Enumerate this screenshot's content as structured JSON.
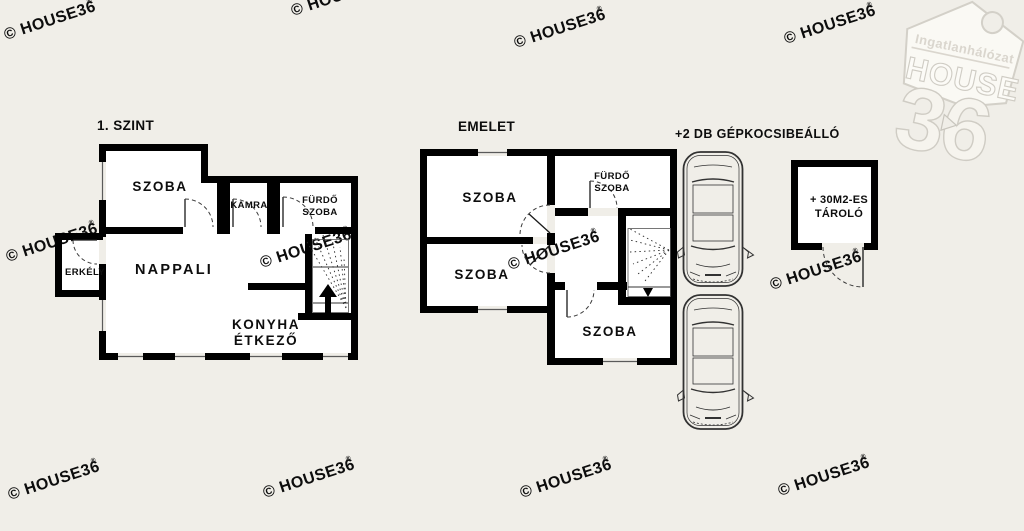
{
  "colors": {
    "background": "#f0eee8",
    "wall": "#000000",
    "room_fill": "#ffffff",
    "watermark": "#dad6ce",
    "logo_outline": "#cfccc4"
  },
  "watermark": {
    "text": "© HOUSE36",
    "reg": "®"
  },
  "logo": {
    "network": "Ingatlanhálózat",
    "brand": "HOUSE",
    "number": "36"
  },
  "floor1": {
    "title": "1. SZINT",
    "rooms": {
      "szoba": "SZOBA",
      "kamra": "KAMRA",
      "furdo_line1": "FÜRDŐ",
      "furdo_line2": "SZOBA",
      "nappali": "NAPPALI",
      "erkely": "ERKÉLY",
      "konyha_line1": "KONYHA",
      "konyha_line2": "ÉTKEZŐ"
    }
  },
  "floor2": {
    "title": "EMELET",
    "rooms": {
      "szoba_top": "SZOBA",
      "szoba_middle": "SZOBA",
      "szoba_bottom": "SZOBA",
      "furdo_line1": "FÜRDŐ",
      "furdo_line2": "SZOBA"
    }
  },
  "parking": {
    "title": "+2 DB GÉPKOCSIBEÁLLÓ",
    "car_count": 2
  },
  "storage": {
    "line1": "+ 30M2-ES",
    "line2": "TÁROLÓ"
  }
}
